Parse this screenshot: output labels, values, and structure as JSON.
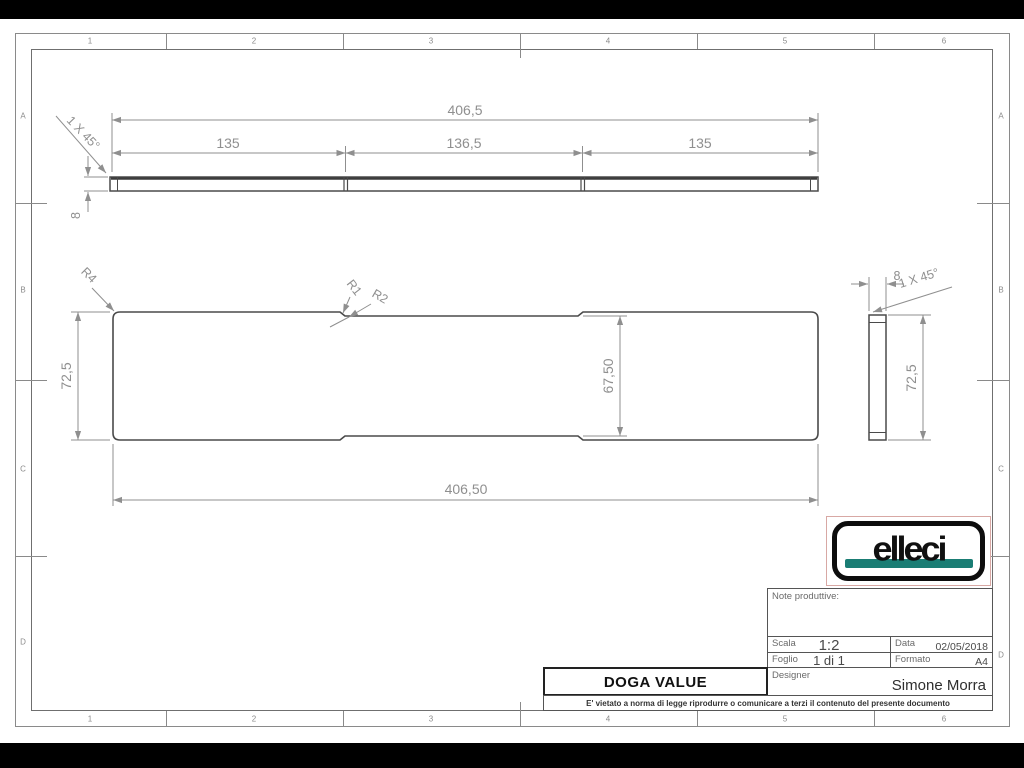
{
  "sheet": {
    "grid": {
      "cols": [
        "1",
        "2",
        "3",
        "4",
        "5",
        "6"
      ],
      "rows": [
        "A",
        "B",
        "C",
        "D"
      ]
    },
    "views": {
      "top": {
        "total": "406,5",
        "seg_left": "135",
        "seg_mid": "136,5",
        "seg_right": "135",
        "thickness": "8",
        "chamfer": "1 X 45°"
      },
      "front": {
        "height": "72,5",
        "inner_height": "67,50",
        "total": "406,50",
        "r_corner": "R4",
        "r_step1": "R1",
        "r_step2": "R2"
      },
      "side": {
        "width": "8",
        "chamfer": "1 X 45°",
        "height": "72,5"
      }
    },
    "logo": {
      "text": "elleci",
      "accent": "#1a7d74"
    },
    "title_block": {
      "note_label": "Note produttive:",
      "scala_label": "Scala",
      "scala_value": "1:2",
      "data_label": "Data",
      "data_value": "02/05/2018",
      "foglio_label": "Foglio",
      "foglio_value": "1 di 1",
      "formato_label": "Formato",
      "formato_value": "A4",
      "designer_label": "Designer",
      "designer_value": "Simone Morra",
      "title": "DOGA VALUE",
      "disclaimer": "E' vietato a norma di legge riprodurre o comunicare a terzi il contenuto del presente documento"
    }
  }
}
